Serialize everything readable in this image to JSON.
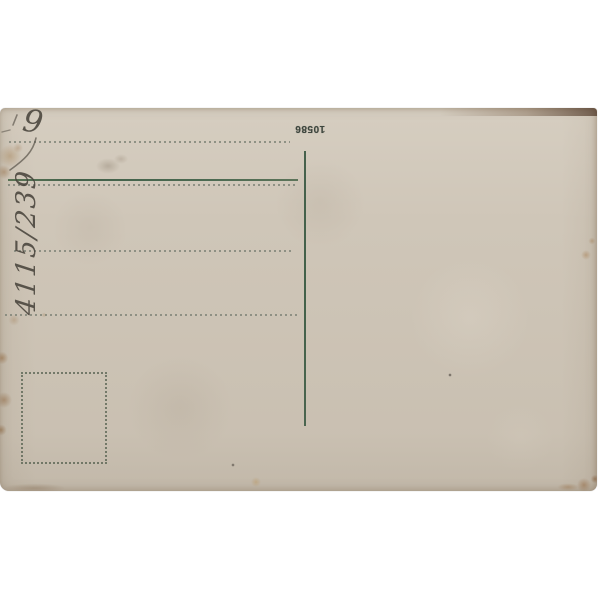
{
  "postcard": {
    "serial_number": "10586",
    "corner_note": "9",
    "side_note": "4115/239"
  },
  "colors": {
    "background": "#ffffff",
    "paper": "#cfc6b8",
    "line-green": "#42614a",
    "dotted": "#7e8377",
    "print-ink": "#3e463e",
    "pencil": "rgba(72,67,59,0.88)"
  }
}
